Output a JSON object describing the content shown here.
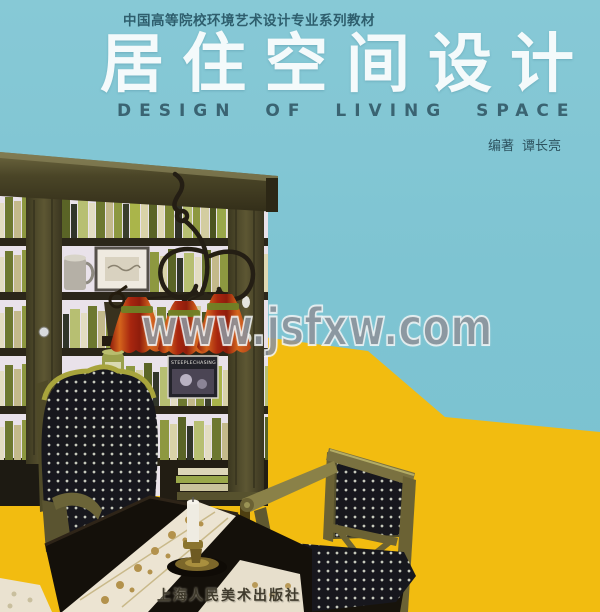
{
  "cover": {
    "series_title": "中国高等院校环境艺术设计专业系列教材",
    "title": "居住空间设计",
    "english_title": "DESIGN OF LIVING SPACE",
    "author": {
      "prefix": "编著",
      "name": "谭长亮"
    },
    "publisher": "上海人民美术出版社",
    "watermark": "www.jsfxw.com",
    "colors": {
      "background_teal": "#7ec4d2",
      "background_yellow": "#f2bc10",
      "title_white": "#f4fafb",
      "heading_dark_teal": "#2e5e6d",
      "lampshade_red": "#b5301d",
      "lampshade_orange": "#d4641c",
      "wood_olive": "#55502e",
      "watermark_gray": "#858c96"
    }
  },
  "photo": {
    "magazine_title": "STEEPLECHASING"
  }
}
